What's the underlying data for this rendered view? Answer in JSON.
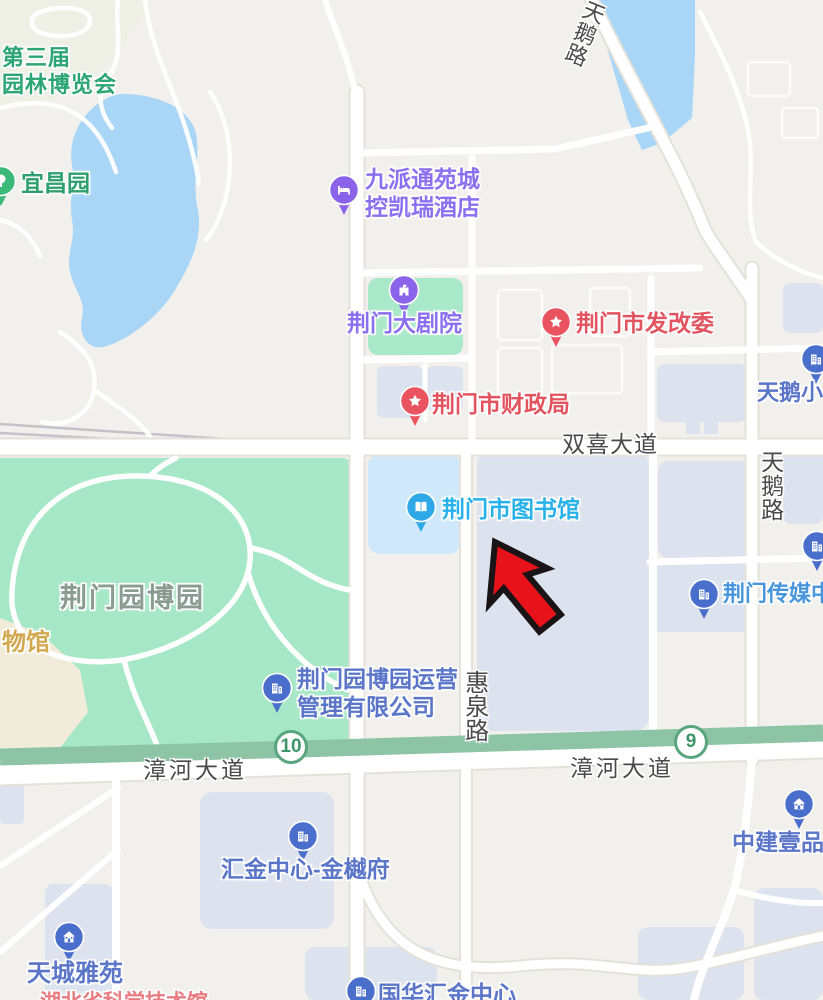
{
  "map": {
    "background_color": "#f2f0ec",
    "colors": {
      "park_green": "#a5e7c6",
      "water_blue": "#a9d6f7",
      "building_gray_blue": "#dce3ee",
      "library_building_blue": "#cfe9fa",
      "highway_band_green": "#8cc4a5",
      "road_white": "#ffffff",
      "poi_blue_pin": "#4a6ecb",
      "poi_purple_pin": "#8a63e8",
      "poi_red_pin": "#ea5460",
      "poi_cyan_pin": "#2fa8e8",
      "poi_green_pin": "#3cb878"
    },
    "annotation_arrow": {
      "fill": "#e8121a",
      "stroke": "#1a1416"
    },
    "route_shields": [
      {
        "text": "10",
        "x": 291,
        "y": 747
      },
      {
        "text": "9",
        "x": 691,
        "y": 742
      }
    ],
    "road_labels": [
      {
        "text": "双喜大道",
        "x": 562,
        "y": 431,
        "mode": "h",
        "size": 23,
        "spacing": 1
      },
      {
        "text": "漳河大道",
        "x": 143,
        "y": 757,
        "mode": "h",
        "size": 23,
        "spacing": 3
      },
      {
        "text": "漳河大道",
        "x": 570,
        "y": 755,
        "mode": "h",
        "size": 23,
        "spacing": 3
      },
      {
        "text": "惠泉路",
        "x": 459,
        "y": 670,
        "mode": "v",
        "size": 24,
        "spacing": 0
      },
      {
        "text": "天鹅路",
        "x": 756,
        "y": 450,
        "mode": "v",
        "size": 23,
        "spacing": 1
      },
      {
        "text": "天鹅路",
        "x": 584,
        "y": -4,
        "mode": "v",
        "size": 22,
        "spacing": 1,
        "rotate": 22
      }
    ],
    "area_labels": [
      {
        "text": "第三届",
        "x": 2,
        "y": 45,
        "color": "#2ba573",
        "size": 22,
        "spacing": 1
      },
      {
        "text": "园林博览会",
        "x": 2,
        "y": 72,
        "color": "#2ba573",
        "size": 22,
        "spacing": 1
      },
      {
        "text": "荆门园博园",
        "x": 60,
        "y": 582,
        "color": "#8a9b91",
        "size": 27,
        "spacing": 2
      },
      {
        "text": "物馆",
        "x": 2,
        "y": 629,
        "color": "#d2a94f",
        "size": 24,
        "spacing": 0
      },
      {
        "text": "湖北省科学技术馆",
        "x": 40,
        "y": 990,
        "color": "#e87b80",
        "size": 21,
        "spacing": 0
      }
    ],
    "pois": [
      {
        "id": "yichang-garden",
        "name": "宜昌园",
        "icon": "tree-icon",
        "pin": {
          "x": 1,
          "y": 181
        },
        "color": "#3cb878",
        "text_color": "#2ea06e",
        "label": {
          "x": 21,
          "y": 170,
          "size": 23,
          "lines": [
            "宜昌园"
          ]
        }
      },
      {
        "id": "jiupai-hotel",
        "name": "九派通苑城控凯瑞酒店",
        "icon": "bed-icon",
        "pin": {
          "x": 344,
          "y": 190
        },
        "color": "#8a63e8",
        "text_color": "#8a70f0",
        "label": {
          "x": 365,
          "y": 166,
          "size": 23,
          "lines": [
            "九派通苑城",
            "控凯瑞酒店"
          ]
        }
      },
      {
        "id": "grand-theater",
        "name": "荆门大剧院",
        "icon": "theater-icon",
        "pin": {
          "x": 404,
          "y": 290
        },
        "color": "#8a63e8",
        "text_color": "#8a70f0",
        "label": {
          "x": 347,
          "y": 310,
          "size": 23,
          "lines": [
            "荆门大剧院"
          ]
        }
      },
      {
        "id": "fagaiwei",
        "name": "荆门市发改委",
        "icon": "star-icon",
        "pin": {
          "x": 556,
          "y": 322
        },
        "color": "#ea5460",
        "text_color": "#e25560",
        "label": {
          "x": 576,
          "y": 310,
          "size": 23,
          "lines": [
            "荆门市发改委"
          ]
        }
      },
      {
        "id": "caizhengju",
        "name": "荆门市财政局",
        "icon": "star-icon",
        "pin": {
          "x": 415,
          "y": 401
        },
        "color": "#ea5460",
        "text_color": "#e25560",
        "label": {
          "x": 432,
          "y": 391,
          "size": 23,
          "lines": [
            "荆门市财政局"
          ]
        }
      },
      {
        "id": "city-library",
        "name": "荆门市图书馆",
        "icon": "book-icon",
        "pin": {
          "x": 421,
          "y": 507
        },
        "color": "#2fa8e8",
        "text_color": "#29b2ea",
        "label": {
          "x": 442,
          "y": 496,
          "size": 23,
          "lines": [
            "荆门市图书馆"
          ]
        }
      },
      {
        "id": "yunying-company",
        "name": "荆门园博园运营管理有限公司",
        "icon": "building-icon",
        "pin": {
          "x": 277,
          "y": 688
        },
        "color": "#4a6ecb",
        "text_color": "#5b76c8",
        "label": {
          "x": 297,
          "y": 666,
          "size": 23,
          "lines": [
            "荆门园博园运营",
            "管理有限公司"
          ]
        }
      },
      {
        "id": "media-center",
        "name": "荆门传媒中心",
        "icon": "building-icon",
        "pin": {
          "x": 704,
          "y": 594
        },
        "color": "#4a6ecb",
        "text_color": "#4796dd",
        "label": {
          "x": 723,
          "y": 581,
          "size": 22,
          "lines": [
            "荆门传媒中心"
          ]
        }
      },
      {
        "id": "tiane-xiaoqu",
        "name": "天鹅小区",
        "icon": "building-icon",
        "pin": {
          "x": 816,
          "y": 359
        },
        "color": "#4a6ecb",
        "text_color": "#5b76c8",
        "label": {
          "x": 757,
          "y": 380,
          "size": 22,
          "lines": [
            "天鹅小区"
          ]
        }
      },
      {
        "id": "huijin-center",
        "name": "汇金中心-金樾府",
        "icon": "building-icon",
        "pin": {
          "x": 303,
          "y": 836
        },
        "color": "#4a6ecb",
        "text_color": "#5b76c8",
        "label": {
          "x": 221,
          "y": 856,
          "size": 23,
          "lines": [
            "汇金中心-金樾府"
          ]
        }
      },
      {
        "id": "zhongjian-yipin",
        "name": "中建壹品",
        "icon": "house-icon",
        "pin": {
          "x": 799,
          "y": 804
        },
        "color": "#4a6ecb",
        "text_color": "#5b76c8",
        "label": {
          "x": 732,
          "y": 829,
          "size": 23,
          "lines": [
            "中建壹品"
          ]
        }
      },
      {
        "id": "tiancheng-yayuan",
        "name": "天城雅苑",
        "icon": "house-icon",
        "pin": {
          "x": 69,
          "y": 937
        },
        "color": "#4a6ecb",
        "text_color": "#5b76c8",
        "label": {
          "x": 27,
          "y": 960,
          "size": 24,
          "lines": [
            "天城雅苑"
          ]
        }
      },
      {
        "id": "guohua-huijin",
        "name": "国华汇金中心",
        "icon": "building-icon",
        "pin": {
          "x": 361,
          "y": 991
        },
        "color": "#4a6ecb",
        "text_color": "#5b76c8",
        "label": {
          "x": 378,
          "y": 981,
          "size": 23,
          "lines": [
            "国华汇金中心"
          ]
        }
      },
      {
        "id": "edge-poi",
        "name": "",
        "icon": "building-icon",
        "pin": {
          "x": 817,
          "y": 546
        },
        "color": "#4a6ecb",
        "text_color": "#5b76c8"
      }
    ]
  }
}
